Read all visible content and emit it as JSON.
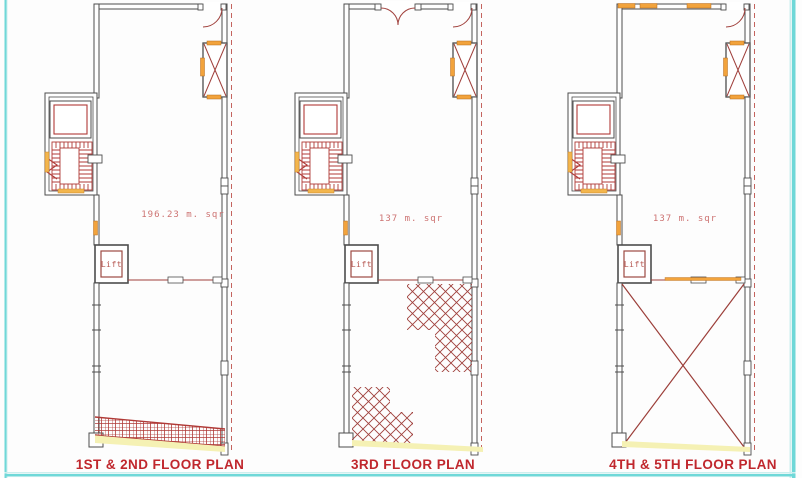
{
  "drawing": {
    "colors": {
      "frame_cyan": "#6fd8d8",
      "frame_cyan_light": "#cdeeee",
      "wall_gray": "#4d4d4d",
      "cad_red": "#b03a37",
      "hatch_red": "#a0403c",
      "dashed_boundary_red": "#c4635e",
      "accent_orange": "#f2a33c",
      "accent_orange_border": "#b46a1e",
      "ramp_yellow": "#f5f1b4",
      "title_red": "#c0272d",
      "area_label_red": "#cd7372"
    },
    "plans": [
      {
        "title": "1ST & 2ND FLOOR PLAN",
        "area_label": "196.23 m. sqr",
        "lift_label": "Lift"
      },
      {
        "title": "3RD FLOOR PLAN",
        "area_label": "137 m. sqr",
        "lift_label": "Lift"
      },
      {
        "title": "4TH & 5TH FLOOR PLAN",
        "area_label": "137 m. sqr",
        "lift_label": "Lift"
      }
    ]
  }
}
